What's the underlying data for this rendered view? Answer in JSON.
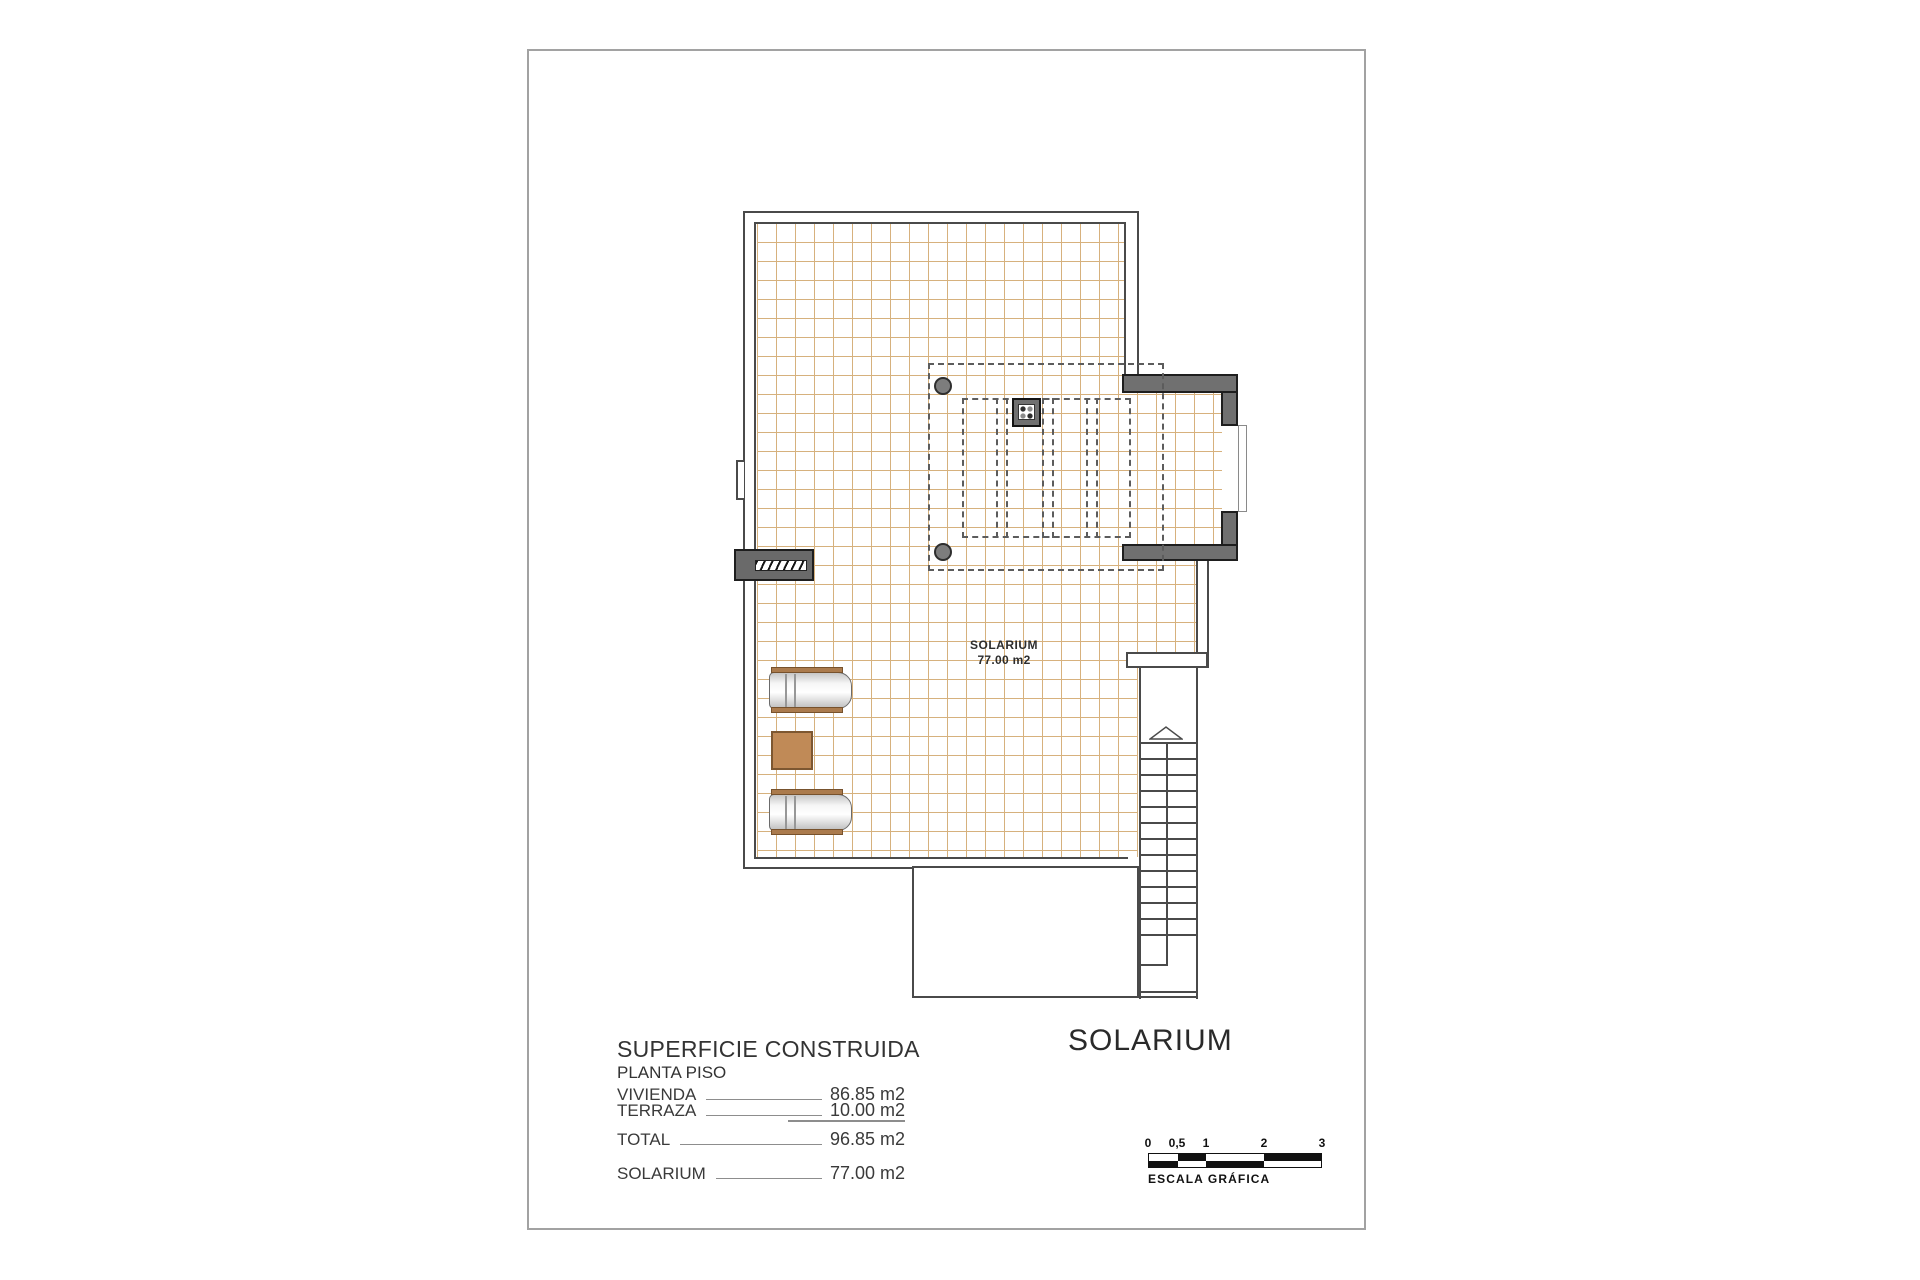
{
  "plan": {
    "room_label": "SOLARIUM",
    "room_area": "77.00 m2"
  },
  "summary": {
    "title": "SUPERFICIE CONSTRUIDA",
    "subtitle": "PLANTA PISO",
    "rows": [
      {
        "label": "VIVIENDA",
        "value": "86.85 m2"
      },
      {
        "label": "TERRAZA",
        "value": "10.00 m2"
      },
      {
        "label": "TOTAL",
        "value": "96.85 m2"
      },
      {
        "label": "SOLARIUM",
        "value": "77.00 m2"
      }
    ]
  },
  "sheet_title": "SOLARIUM",
  "scale": {
    "caption": "ESCALA GRÁFICA",
    "ticks": [
      "0",
      "0,5",
      "1",
      "2",
      "3"
    ]
  },
  "colors": {
    "grid_line": "#d0a467",
    "wall": "#4a4a4a",
    "dark_fill": "#707070",
    "accent_brown": "#c08a57"
  }
}
